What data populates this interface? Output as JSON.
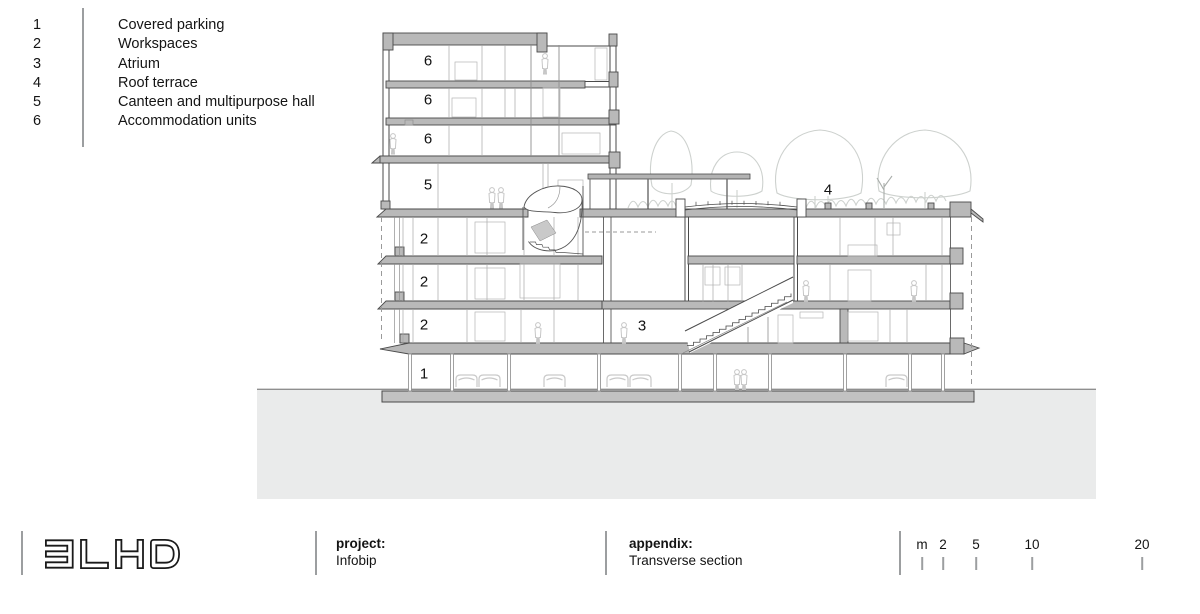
{
  "legend": {
    "items": [
      {
        "num": "1",
        "label": "Covered parking"
      },
      {
        "num": "2",
        "label": "Workspaces"
      },
      {
        "num": "3",
        "label": "Atrium"
      },
      {
        "num": "4",
        "label": "Roof terrace"
      },
      {
        "num": "5",
        "label": "Canteen and multipurpose hall"
      },
      {
        "num": "6",
        "label": "Accommodation units"
      }
    ]
  },
  "drawing": {
    "floor_labels": [
      {
        "text": "6"
      },
      {
        "text": "6"
      },
      {
        "text": "6"
      },
      {
        "text": "5"
      },
      {
        "text": "2"
      },
      {
        "text": "2"
      },
      {
        "text": "2"
      },
      {
        "text": "1"
      },
      {
        "text": "3"
      },
      {
        "text": "4"
      }
    ]
  },
  "footer": {
    "logo_text": "3LHD",
    "project_label": "project:",
    "project_value": "Infobip",
    "appendix_label": "appendix:",
    "appendix_value": "Transverse section"
  },
  "scale_bar": {
    "labels": [
      {
        "text": "m"
      },
      {
        "text": "2"
      },
      {
        "text": "5"
      },
      {
        "text": "10"
      },
      {
        "text": "20"
      }
    ]
  },
  "colors": {
    "line_dark": "#4a4a4a",
    "slab_gray": "#b9b9b9",
    "ground_gray": "#eaebeb",
    "light_sketch": "#cdd1ce",
    "divider_gray": "#9c9ea0"
  }
}
